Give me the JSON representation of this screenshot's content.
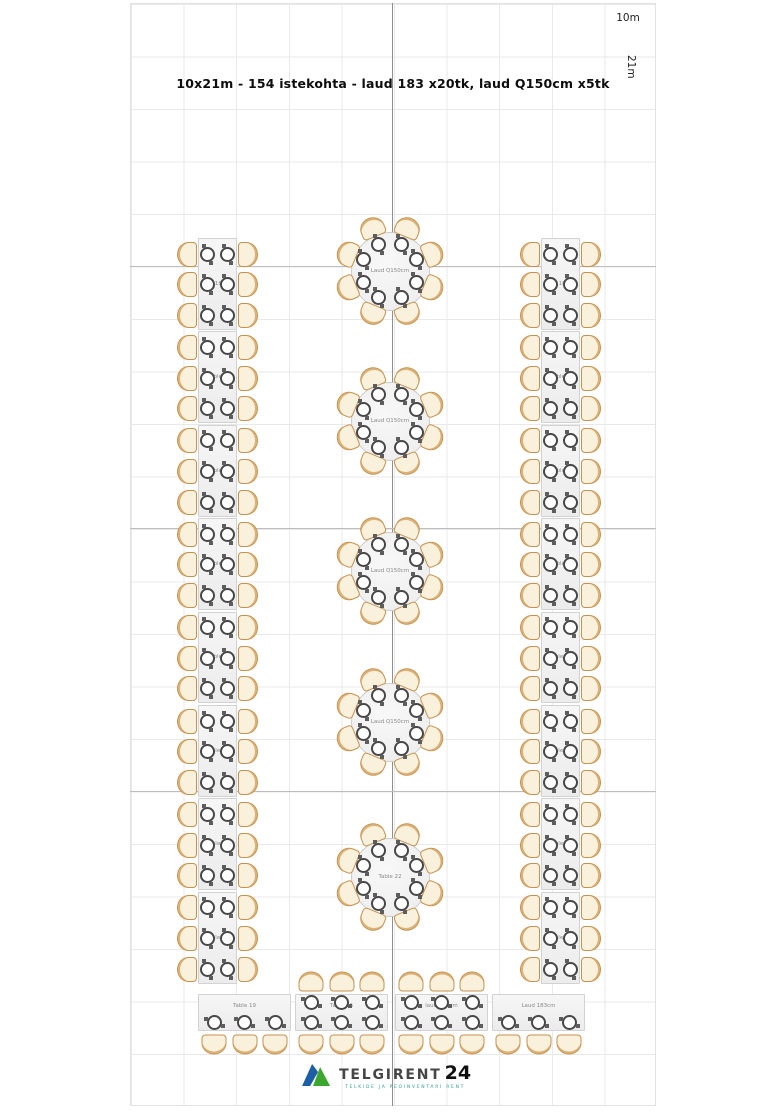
{
  "title": "10x21m - 154 istekohta - laud 183 x20tk, laud Q150cm x5tk",
  "logo": {
    "name": "TELGIRENT",
    "number": "24",
    "tagline": "TELKIDE JA PEOINVENTARI RENT",
    "green": "#3da62f",
    "blue": "#1d5fa5"
  },
  "colors": {
    "chair_fill": "#faf1dc",
    "chair_border": "#c5914e",
    "table_fill": "#f0f0f0",
    "table_border": "#d2d2d2",
    "plate_ring": "#474747",
    "grid_line": "#e9e9e9",
    "grid_major": "#bdbdbd",
    "center_axis": "#8f8f8f"
  },
  "plan": {
    "grid": {
      "cols": 10,
      "rows": 21,
      "cell_w": 52.6,
      "cell_h": 52.5,
      "origin_x": 130,
      "origin_y": 3,
      "width_label": "10m",
      "height_label": "21m",
      "major_h_y": [
        265.5,
        528,
        790.5
      ],
      "center_axis_x": 393
    },
    "long_table_columns": [
      {
        "side": "left",
        "x": 198,
        "y": 238,
        "table_w": 39,
        "table_h": 93.4,
        "count": 8,
        "seats_per_table": 6,
        "labels": [
          "laud 183cm",
          "Table 9",
          "Table 3",
          "Table 6",
          "Table 8",
          "Table 12",
          "Table 14",
          "Table 18"
        ]
      },
      {
        "side": "right",
        "x": 541,
        "y": 238,
        "table_w": 39,
        "table_h": 93.4,
        "count": 8,
        "seats_per_table": 6,
        "labels": [
          "Laud 183cm",
          "Table 7",
          "Table 2",
          "Table 5",
          "Table 10",
          "Table 11",
          "Table 13",
          "Table 17"
        ]
      }
    ],
    "round_tables": {
      "cx": 390,
      "diameter": 79,
      "seats_each": 8,
      "items": [
        {
          "cy": 271,
          "label": "Laud Q150cm"
        },
        {
          "cy": 421,
          "label": "Laud Q150cm"
        },
        {
          "cy": 571,
          "label": "Laud Q150cm"
        },
        {
          "cy": 722,
          "label": "Laud Q150cm"
        },
        {
          "cy": 877,
          "label": "Table 22"
        }
      ]
    },
    "bottom_tables": [
      {
        "x": 198,
        "y": 994,
        "w": 93,
        "h": 37,
        "label": "Table 19",
        "seats_top": 0,
        "seats_bottom": 3
      },
      {
        "x": 295,
        "y": 994,
        "w": 93,
        "h": 37,
        "label": "Table 16",
        "seats_top": 3,
        "seats_bottom": 3
      },
      {
        "x": 395,
        "y": 994,
        "w": 93,
        "h": 37,
        "label": "laud 183cm",
        "seats_top": 3,
        "seats_bottom": 3
      },
      {
        "x": 492,
        "y": 994,
        "w": 93,
        "h": 37,
        "label": "Laud 183cm",
        "seats_top": 0,
        "seats_bottom": 3
      }
    ]
  }
}
